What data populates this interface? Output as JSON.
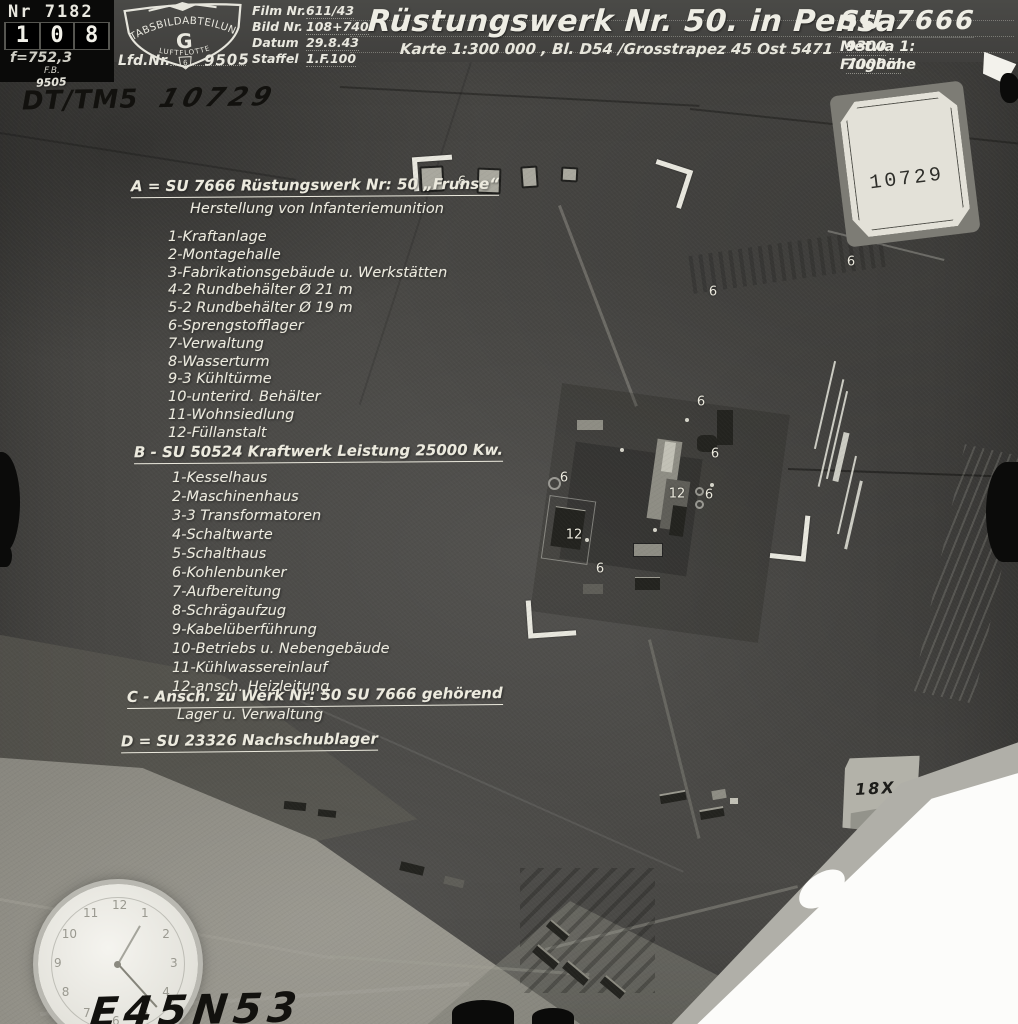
{
  "header": {
    "left_block": {
      "nr": "Nr 7182",
      "counter_digits": [
        "1",
        "0",
        "8"
      ],
      "focal": "f=752,3",
      "fb_label": "F.B.",
      "fb_number": "9505"
    },
    "emblem": {
      "arc_text": "STABSBILDABTEILUNG",
      "center_letter": "G",
      "bottom_text": "LUFTFLOTTE",
      "bottom_number": "6"
    },
    "lfd": {
      "label": "Lfd.Nr.",
      "value": "9505"
    },
    "film_fields": [
      {
        "label": "Film Nr.",
        "value": "611/43"
      },
      {
        "label": "Bild Nr.",
        "value": "108+740"
      },
      {
        "label": "Datum",
        "value": "29.8.43"
      },
      {
        "label": "Staffel",
        "value": "1.F.100"
      }
    ],
    "title": "Rüstungswerk Nr. 50. in Pensa",
    "subtitle": "Karte 1:300 000 , Bl.  D54  /Grosstrapez  45 Ost 5471",
    "right_block": {
      "code": "SU 7666",
      "scale_label": "Metwa 1:",
      "scale_value": "9300",
      "altitude_label": "Flughöhe",
      "altitude_value": "7000m"
    }
  },
  "handwritten": {
    "top_left_code": "DT/TM5",
    "top_left_number": "10729",
    "bottom_left_coords": "E45N53",
    "magnification": "18X"
  },
  "stamp": {
    "number": "10729"
  },
  "annotations": {
    "section_a": {
      "heading": "A = SU 7666  Rüstungswerk Nr: 50 „Frunse“",
      "subheading": "Herstellung von Infanteriemunition",
      "items": [
        "1-Kraftanlage",
        "2-Montagehalle",
        "3-Fabrikationsgebäude u. Werkstätten",
        "4-2 Rundbehälter Ø 21 m",
        "5-2 Rundbehälter Ø 19 m",
        "6-Sprengstofflager",
        "7-Verwaltung",
        "8-Wasserturm",
        "9-3 Kühltürme",
        "10-unterird. Behälter",
        "11-Wohnsiedlung",
        "12-Füllanstalt"
      ]
    },
    "section_b": {
      "heading": "B - SU 50524  Kraftwerk   Leistung 25000 Kw.",
      "items": [
        "1-Kesselhaus",
        "2-Maschinenhaus",
        "3-3 Transformatoren",
        "4-Schaltwarte",
        "5-Schalthaus",
        "6-Kohlenbunker",
        "7-Aufbereitung",
        "8-Schrägaufzug",
        "9-Kabelüberführung",
        "10-Betriebs u. Nebengebäude",
        "11-Kühlwassereinlauf",
        "12-ansch. Heizleitung"
      ]
    },
    "section_c": {
      "heading": "C - Ansch. zu Werk Nr: 50  SU 7666 gehörend",
      "subheading": "Lager  u. Verwaltung"
    },
    "section_d": {
      "heading": "D = SU 23326  Nachschublager"
    }
  },
  "photo_markers": [
    {
      "label": "6",
      "x": 462,
      "y": 182
    },
    {
      "label": "6",
      "x": 713,
      "y": 292
    },
    {
      "label": "6",
      "x": 851,
      "y": 262
    },
    {
      "label": "6",
      "x": 701,
      "y": 402
    },
    {
      "label": "6",
      "x": 715,
      "y": 454
    },
    {
      "label": "6",
      "x": 564,
      "y": 478
    },
    {
      "label": "12",
      "x": 677,
      "y": 494
    },
    {
      "label": "6",
      "x": 709,
      "y": 495
    },
    {
      "label": "12",
      "x": 574,
      "y": 535
    },
    {
      "label": "6",
      "x": 600,
      "y": 569
    }
  ],
  "colors": {
    "photo_base": "#494845",
    "annotation_ink": "#eceade",
    "header_bar": "#403f3d",
    "stamp_paper": "#e3e1d8",
    "torn_paper": "#fcfcfa",
    "handwriting_ink": "#12110e"
  }
}
